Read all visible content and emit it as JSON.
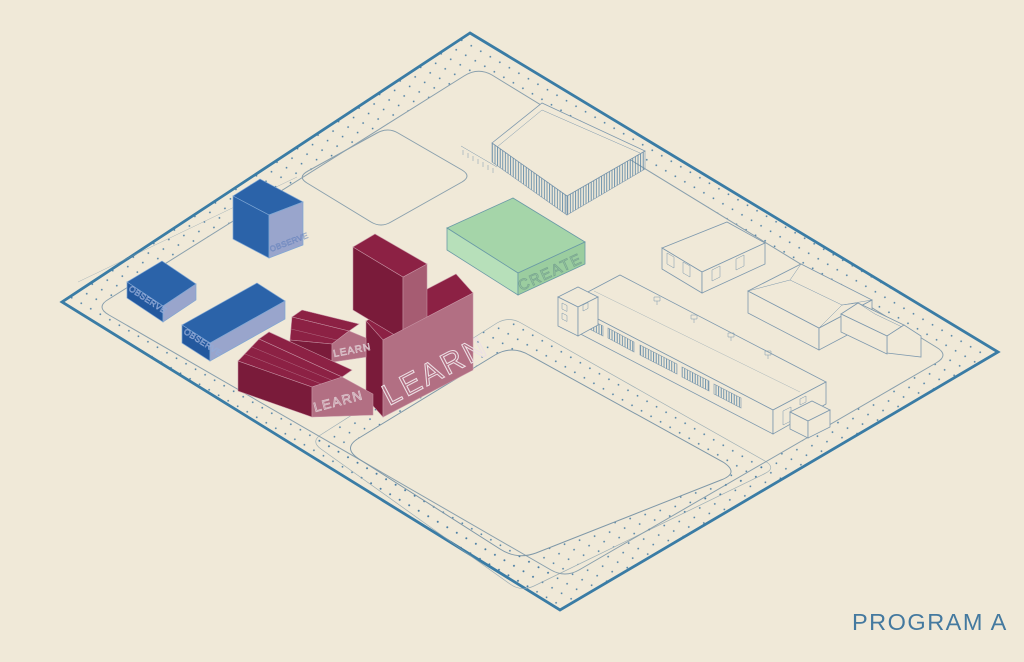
{
  "title": "PROGRAM A",
  "labels": {
    "program_title": "PROGRAM A",
    "learn_main": "LEARN",
    "learn_barn": "LEARN",
    "learn_wing": "LEARN",
    "create": "CREATE",
    "observe_cube": "OBSERVE",
    "observe_box": "OBSERVE",
    "observe_bar": "OBSERVE"
  },
  "palette": {
    "bg": "#f0e9d8",
    "boundary": "#3a7ca5",
    "loop": "#8aa0ad",
    "field": "#7f98a8",
    "dot": "#4379a1",
    "outline": "#7d98ad",
    "hatch": "#507fa2",
    "blueTop": "#2b63a9",
    "blueDark": "#23589e",
    "blueLight": "#99a5cc",
    "blueEdge": "#7fa6d3",
    "blueText": "#93abd8",
    "cubeTextFaint": "#4d72b5",
    "maroonTop": "#8c2144",
    "maroonDark": "#7a1b3a",
    "maroonMid": "#a65c72",
    "maroonLight": "#b26f83",
    "maroonEdge": "#c795a5",
    "learnTextLight": "#ecdfe4",
    "learnTextSmall": "#dcc6cd",
    "greenTop": "#a5d5a9",
    "greenLight": "#b7e0ba",
    "greenMid": "#9bcd9f",
    "greenEdge": "#6a9aa6",
    "createText": "#7aa691",
    "programText": "#44799f"
  }
}
